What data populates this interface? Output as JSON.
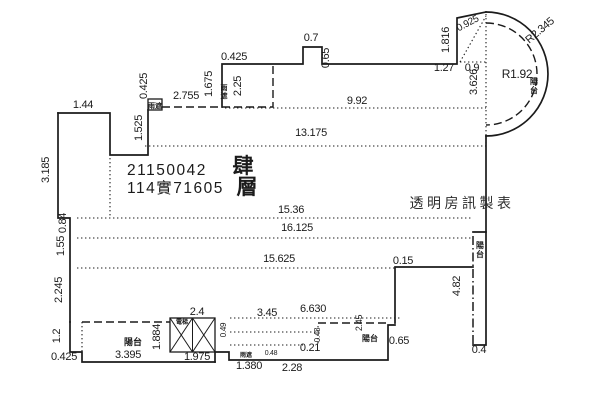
{
  "document": {
    "kind": "building-survey-floor-plan",
    "floor_text": "肆層",
    "case_number": "21150042",
    "file_number": "114實71605",
    "watermark": "透明房訊製表",
    "colors": {
      "ink": "#1b1b1b",
      "watermark": "#2e2e2e",
      "paper": "#ffffff"
    }
  },
  "labels": [
    {
      "name": "dim-1-44",
      "text": "1.44",
      "x": 83,
      "y": 108,
      "size": 11,
      "cls": "dim"
    },
    {
      "name": "dim-3-185",
      "text": "3.185",
      "x": 49,
      "y": 170,
      "size": 11,
      "rot": -90,
      "cls": "dim"
    },
    {
      "name": "dim-1-525",
      "text": "1.525",
      "x": 142,
      "y": 128,
      "size": 11,
      "rot": -90,
      "cls": "dim"
    },
    {
      "name": "dim-0-425-left",
      "text": "0.425",
      "x": 147,
      "y": 86,
      "size": 11,
      "rot": -90,
      "cls": "dim"
    },
    {
      "name": "dim-2-755",
      "text": "2.755",
      "x": 186,
      "y": 99,
      "size": 11,
      "cls": "dim"
    },
    {
      "name": "dim-1-675",
      "text": "1.675",
      "x": 212,
      "y": 84,
      "size": 11,
      "rot": -90,
      "cls": "dim"
    },
    {
      "name": "dim-2-25",
      "text": "2.25",
      "x": 241,
      "y": 86,
      "size": 11,
      "rot": -90,
      "cls": "dim"
    },
    {
      "name": "dim-0-425-top",
      "text": "0.425",
      "x": 234,
      "y": 60,
      "size": 11,
      "cls": "dim"
    },
    {
      "name": "dim-0-7",
      "text": "0.7",
      "x": 311,
      "y": 41,
      "size": 11,
      "cls": "dim"
    },
    {
      "name": "dim-0-65-top",
      "text": "0.65",
      "x": 329,
      "y": 58,
      "size": 11,
      "rot": -90,
      "cls": "dim"
    },
    {
      "name": "dim-1-27",
      "text": "1.27",
      "x": 444,
      "y": 71,
      "size": 11,
      "cls": "dim"
    },
    {
      "name": "dim-1-816",
      "text": "1.816",
      "x": 449,
      "y": 40,
      "size": 11,
      "rot": -90,
      "cls": "dim"
    },
    {
      "name": "dim-0-925",
      "text": "0.925",
      "x": 469,
      "y": 26,
      "size": 10,
      "rot": -28,
      "cls": "dim"
    },
    {
      "name": "dim-0-9",
      "text": "0.9",
      "x": 472,
      "y": 71,
      "size": 11,
      "cls": "dim"
    },
    {
      "name": "dim-3-626",
      "text": "3.626",
      "x": 477,
      "y": 82,
      "size": 11,
      "rot": -90,
      "cls": "dim"
    },
    {
      "name": "radius-inner",
      "text": "R1.92",
      "x": 517,
      "y": 78,
      "size": 12,
      "cls": "dim"
    },
    {
      "name": "radius-outer",
      "text": "R2.345",
      "x": 542,
      "y": 33,
      "size": 11,
      "rot": -40,
      "cls": "dim"
    },
    {
      "name": "balcony-arc-label",
      "text": "陽台",
      "x": 534,
      "y": 84,
      "size": 8,
      "vertical": true,
      "cls": "small-cjk"
    },
    {
      "name": "dim-9-92",
      "text": "9.92",
      "x": 357,
      "y": 104,
      "size": 11,
      "cls": "dim"
    },
    {
      "name": "dim-13-175",
      "text": "13.175",
      "x": 311,
      "y": 136,
      "size": 11,
      "cls": "dim"
    },
    {
      "name": "case-number",
      "text": "21150042",
      "x": 127,
      "y": 175,
      "size": 15.5,
      "anchor": "start",
      "cls": "case"
    },
    {
      "name": "file-number",
      "text": "114實71605",
      "x": 127,
      "y": 193,
      "size": 15.5,
      "anchor": "start",
      "cls": "case"
    },
    {
      "name": "floor-char-1",
      "text": "肆",
      "x": 243,
      "y": 173,
      "size": 21,
      "cls": "floor"
    },
    {
      "name": "floor-char-2",
      "text": "層",
      "x": 247,
      "y": 194,
      "size": 21,
      "cls": "floor"
    },
    {
      "name": "watermark",
      "text": "透明房訊製表",
      "x": 462,
      "y": 208,
      "size": 14,
      "cls": "wm"
    },
    {
      "name": "dim-15-36",
      "text": "15.36",
      "x": 291,
      "y": 213,
      "size": 11,
      "cls": "dim"
    },
    {
      "name": "dim-0-84",
      "text": "0.84",
      "x": 66,
      "y": 223,
      "size": 11,
      "rot": -90,
      "cls": "dim"
    },
    {
      "name": "dim-16-125",
      "text": "16.125",
      "x": 297,
      "y": 231,
      "size": 11,
      "cls": "dim"
    },
    {
      "name": "dim-1-55",
      "text": "1.55",
      "x": 64,
      "y": 246,
      "size": 11,
      "rot": -90,
      "cls": "dim"
    },
    {
      "name": "dim-15-625",
      "text": "15.625",
      "x": 279,
      "y": 262,
      "size": 11,
      "cls": "dim"
    },
    {
      "name": "dim-2-245",
      "text": "2.245",
      "x": 62,
      "y": 290,
      "size": 11,
      "rot": -90,
      "cls": "dim"
    },
    {
      "name": "dim-0-15",
      "text": "0.15",
      "x": 403,
      "y": 264,
      "size": 11,
      "cls": "dim"
    },
    {
      "name": "dim-4-82",
      "text": "4.82",
      "x": 460,
      "y": 286,
      "size": 11,
      "rot": -90,
      "cls": "dim"
    },
    {
      "name": "balcony-right-label",
      "text": "陽台",
      "x": 480,
      "y": 248,
      "size": 8,
      "vertical": true,
      "cls": "small-cjk"
    },
    {
      "name": "dim-1-2",
      "text": "1.2",
      "x": 60,
      "y": 336,
      "size": 11,
      "rot": -90,
      "cls": "dim"
    },
    {
      "name": "dim-2-4",
      "text": "2.4",
      "x": 197,
      "y": 315,
      "size": 11,
      "cls": "dim"
    },
    {
      "name": "dim-3-45",
      "text": "3.45",
      "x": 267,
      "y": 316,
      "size": 11,
      "cls": "dim"
    },
    {
      "name": "dim-6-630",
      "text": "6.630",
      "x": 313,
      "y": 312,
      "size": 11,
      "cls": "dim"
    },
    {
      "name": "dim-2-45",
      "text": "2.45",
      "x": 362,
      "y": 323,
      "size": 9,
      "rot": -90,
      "cls": "dim"
    },
    {
      "name": "dim-0-49",
      "text": "0.49",
      "x": 226,
      "y": 330,
      "size": 8,
      "rot": -90,
      "cls": "dim"
    },
    {
      "name": "dim-0-48",
      "text": "0.48",
      "x": 320,
      "y": 335,
      "size": 8,
      "rot": -90,
      "cls": "dim"
    },
    {
      "name": "balcony-bl-label",
      "text": "陽台",
      "x": 133,
      "y": 345,
      "size": 9,
      "cls": "small-cjk"
    },
    {
      "name": "dim-1-884",
      "text": "1.884",
      "x": 160,
      "y": 337,
      "size": 11,
      "rot": -90,
      "cls": "dim"
    },
    {
      "name": "elevator-label",
      "text": "電梯",
      "x": 182,
      "y": 324,
      "size": 6,
      "cls": "small-cjk"
    },
    {
      "name": "balcony-br-label",
      "text": "陽台",
      "x": 370,
      "y": 341,
      "size": 8,
      "cls": "small-cjk"
    },
    {
      "name": "dim-0-21",
      "text": "0.21",
      "x": 310,
      "y": 351,
      "size": 11,
      "cls": "dim"
    },
    {
      "name": "dim-0-65-bottom",
      "text": "0.65",
      "x": 399,
      "y": 344,
      "size": 11,
      "cls": "dim"
    },
    {
      "name": "dim-0-4",
      "text": "0.4",
      "x": 479,
      "y": 353,
      "size": 11,
      "cls": "dim"
    },
    {
      "name": "dim-0-425-bl",
      "text": "0.425",
      "x": 64,
      "y": 360,
      "size": 11,
      "cls": "dim"
    },
    {
      "name": "dim-3-395",
      "text": "3.395",
      "x": 128,
      "y": 358,
      "size": 11,
      "cls": "dim"
    },
    {
      "name": "dim-1-975",
      "text": "1.975",
      "x": 197,
      "y": 360,
      "size": 11,
      "cls": "dim"
    },
    {
      "name": "micro-label-a",
      "text": "雨遮",
      "x": 246,
      "y": 357,
      "size": 6,
      "cls": "small-cjk"
    },
    {
      "name": "micro-label-b",
      "text": "0.48",
      "x": 271,
      "y": 355,
      "size": 7,
      "cls": "dim"
    },
    {
      "name": "dim-1-380",
      "text": "1.380",
      "x": 249,
      "y": 369,
      "size": 11,
      "cls": "dim"
    },
    {
      "name": "dim-2-28",
      "text": "2.28",
      "x": 292,
      "y": 371,
      "size": 11,
      "cls": "dim"
    },
    {
      "name": "canopy-top-label",
      "text": "雨遮",
      "x": 224,
      "y": 90,
      "size": 7,
      "vertical": true,
      "cls": "small-cjk"
    },
    {
      "name": "planter-label",
      "text": "雨遮",
      "x": 155,
      "y": 108,
      "size": 7,
      "cls": "small-cjk"
    }
  ]
}
